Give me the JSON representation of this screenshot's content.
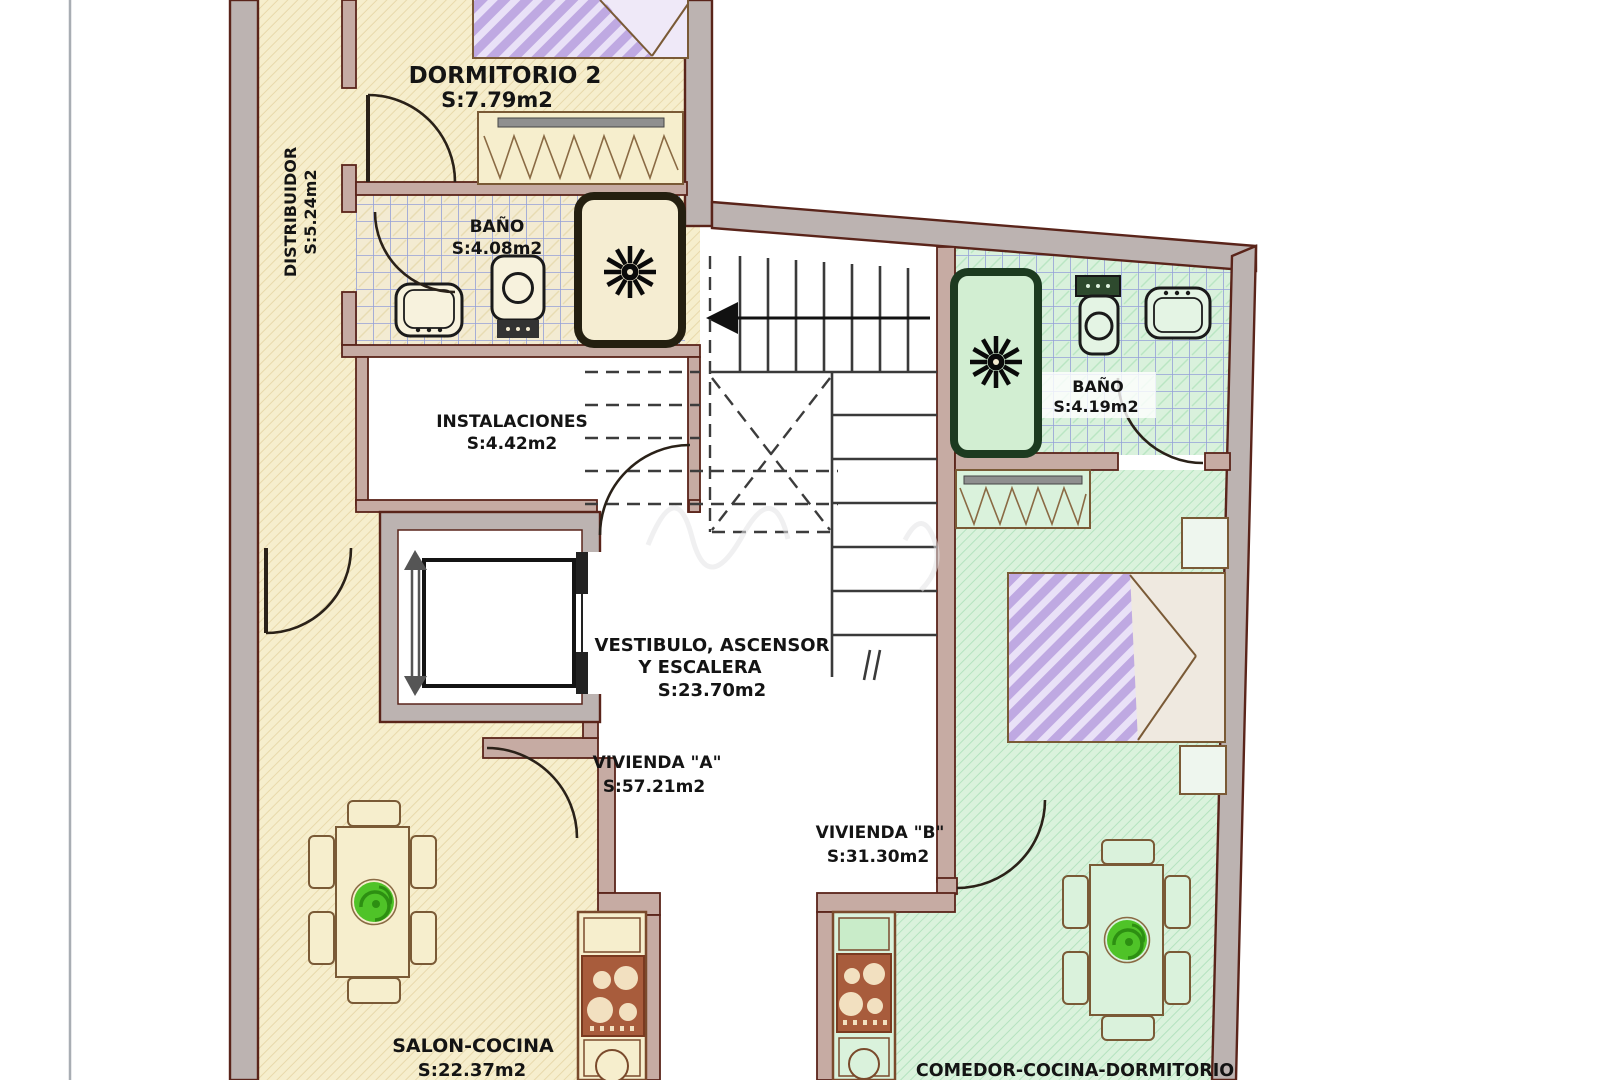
{
  "plan": {
    "rooms": {
      "dormitorio2": {
        "name": "DORMITORIO 2",
        "area": "S:7.79m2"
      },
      "distribuidor": {
        "name": "DISTRIBUIDOR",
        "area": "S:5.24m2"
      },
      "bano_a": {
        "name": "BAÑO",
        "area": "S:4.08m2"
      },
      "instalaciones": {
        "name": "INSTALACIONES",
        "area": "S:4.42m2"
      },
      "vestibulo": {
        "name_line1": "VESTIBULO, ASCENSOR",
        "name_line2": "Y  ESCALERA",
        "area": "S:23.70m2"
      },
      "vivienda_a": {
        "name": "VIVIENDA  \"A\"",
        "area": "S:57.21m2"
      },
      "vivienda_b": {
        "name": "VIVIENDA  \"B\"",
        "area": "S:31.30m2"
      },
      "bano_b": {
        "name": "BAÑO",
        "area": "S:4.19m2"
      },
      "salon_cocina": {
        "name": "SALON-COCINA",
        "area": "S:22.37m2"
      },
      "comedor": {
        "name": "COMEDOR-COCINA-DORMITORIO"
      }
    },
    "colors": {
      "vivienda_a_fill": "#f6eecd",
      "vivienda_b_fill": "#daf2dc",
      "wall_fill": "#bcb3b1",
      "interior_wall_fill": "#c6aba3",
      "wall_line": "#5a241a",
      "tile_line": "#94a0d8",
      "bed_stripe": "#bfa9e2",
      "plant_green": "#4fc328",
      "stove_fill": "#a85c3c"
    }
  }
}
